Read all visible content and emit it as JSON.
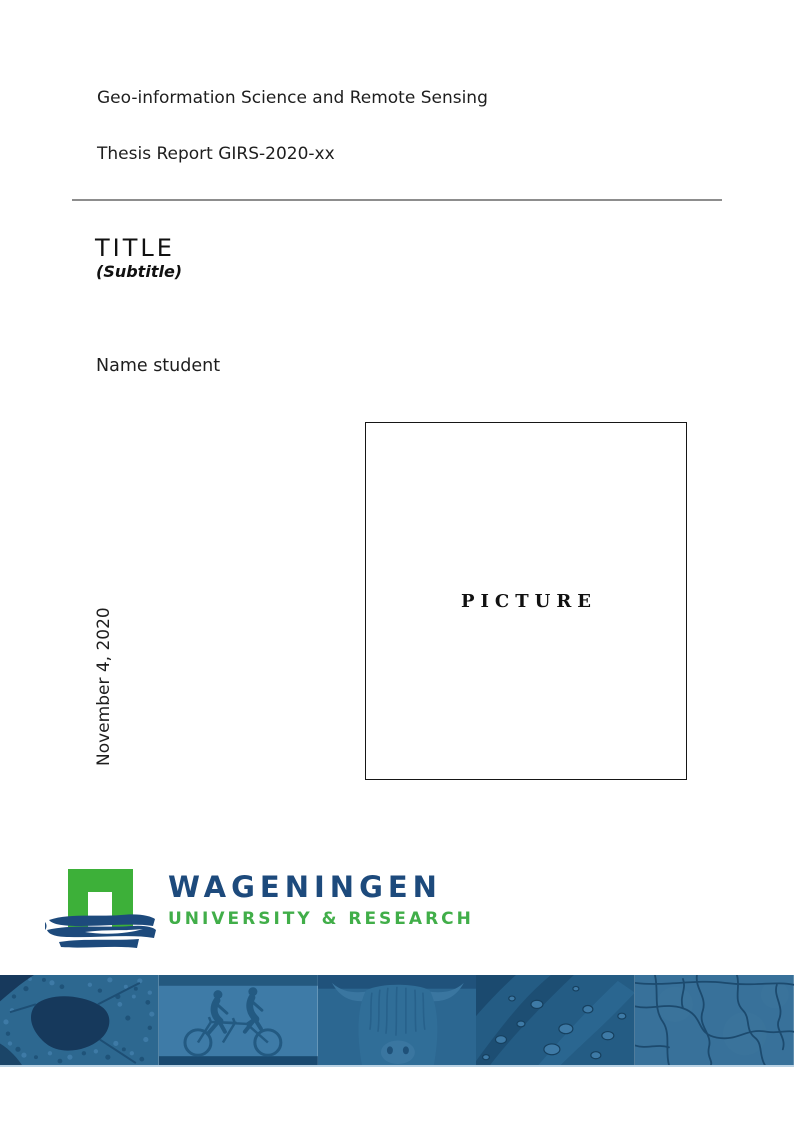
{
  "header": {
    "program": "Geo-information Science and Remote Sensing",
    "report": "Thesis Report GIRS-2020-xx"
  },
  "title_block": {
    "title": "TITLE",
    "subtitle": "(Subtitle)"
  },
  "author": "Name student",
  "date": "November 4, 2020",
  "picture_box": {
    "label": "PICTURE"
  },
  "logo": {
    "wordmark": "WAGENINGEN",
    "tagline": "UNIVERSITY & RESEARCH",
    "mark_icons": [
      "arch-gate-icon",
      "brush-stroke-icon"
    ],
    "colors": {
      "green": "#3DB039",
      "blue": "#1D4A7C",
      "tagline_green": "#41AE49"
    }
  },
  "footer_banner": {
    "tint_base": "#2E6890",
    "segments": [
      {
        "name": "aerial-landscape-photo"
      },
      {
        "name": "tandem-cyclists-photo"
      },
      {
        "name": "highland-cow-photo"
      },
      {
        "name": "leaf-water-droplets-photo"
      },
      {
        "name": "cracked-earth-photo"
      }
    ]
  }
}
